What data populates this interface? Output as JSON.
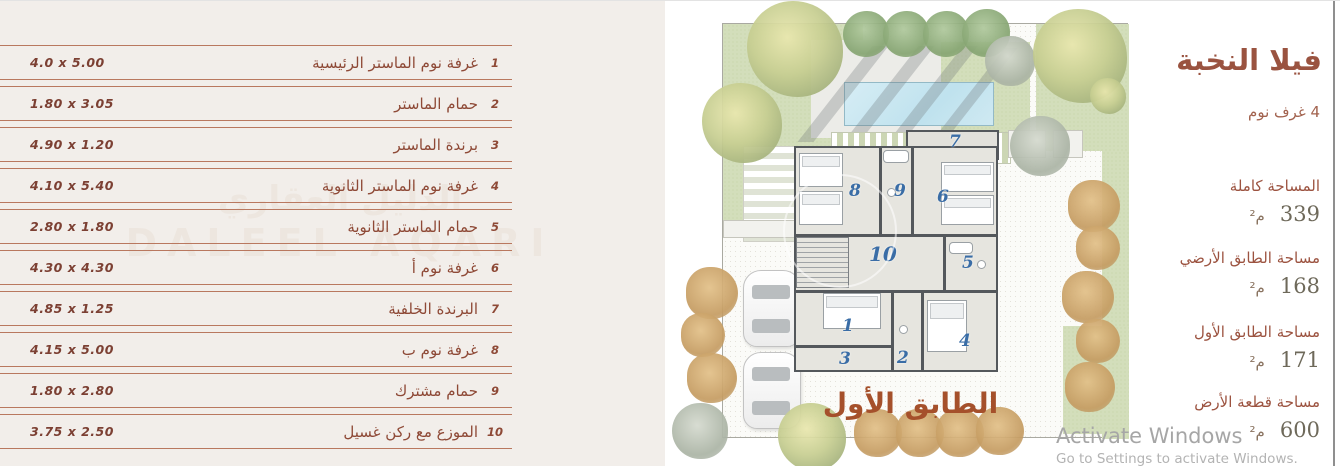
{
  "left_table": {
    "rows": [
      {
        "no": "1",
        "name": "غرفة نوم الماستر الرئيسية",
        "dim": "4.0 x 5.00"
      },
      {
        "no": "2",
        "name": "حمام الماستر",
        "dim": "1.80 x 3.05"
      },
      {
        "no": "3",
        "name": "برندة الماستر",
        "dim": "4.90 x 1.20"
      },
      {
        "no": "4",
        "name": "غرفة نوم الماستر الثانوية",
        "dim": "4.10 x 5.40"
      },
      {
        "no": "5",
        "name": "حمام الماستر الثانوية",
        "dim": "2.80 x 1.80"
      },
      {
        "no": "6",
        "name": "غرفة نوم أ",
        "dim": "4.30 x 4.30"
      },
      {
        "no": "7",
        "name": "البرندة الخلفية",
        "dim": "4.85 x 1.25"
      },
      {
        "no": "8",
        "name": "غرفة نوم ب",
        "dim": "4.15 x 5.00"
      },
      {
        "no": "9",
        "name": "حمام مشترك",
        "dim": "1.80 x 2.80"
      },
      {
        "no": "10",
        "name": "الموزع مع ركن غسيل",
        "dim": "3.75 x 2.50"
      }
    ]
  },
  "plan": {
    "floor_label": "الطابق الأول",
    "room_labels": [
      "1",
      "2",
      "3",
      "4",
      "5",
      "6",
      "7",
      "8",
      "9",
      "10"
    ]
  },
  "info_panel": {
    "title": "فيلا النخبة",
    "subtitle": "4 غرف نوم",
    "areas": [
      {
        "label": "المساحة كاملة",
        "value": "339",
        "unit": "م²"
      },
      {
        "label": "مساحة الطابق الأرضي",
        "value": "168",
        "unit": "م²"
      },
      {
        "label": "مساحة الطابق الأول",
        "value": "171",
        "unit": "م²"
      },
      {
        "label": "مساحة قطعة الأرض",
        "value": "600",
        "unit": "م²"
      }
    ]
  },
  "watermarks": {
    "brand_ar": "الدليل العقاري",
    "brand_en": "DALEEL AQARI",
    "activate_line1": "Activate Windows",
    "activate_line2": "Go to Settings to activate Windows."
  },
  "colors": {
    "accent_terracotta": "#9a5340",
    "table_line": "#b9785f",
    "room_number_blue": "#3a6da6",
    "pool_blue": "#bfe2ee",
    "panel_beige": "#f2eeea"
  }
}
